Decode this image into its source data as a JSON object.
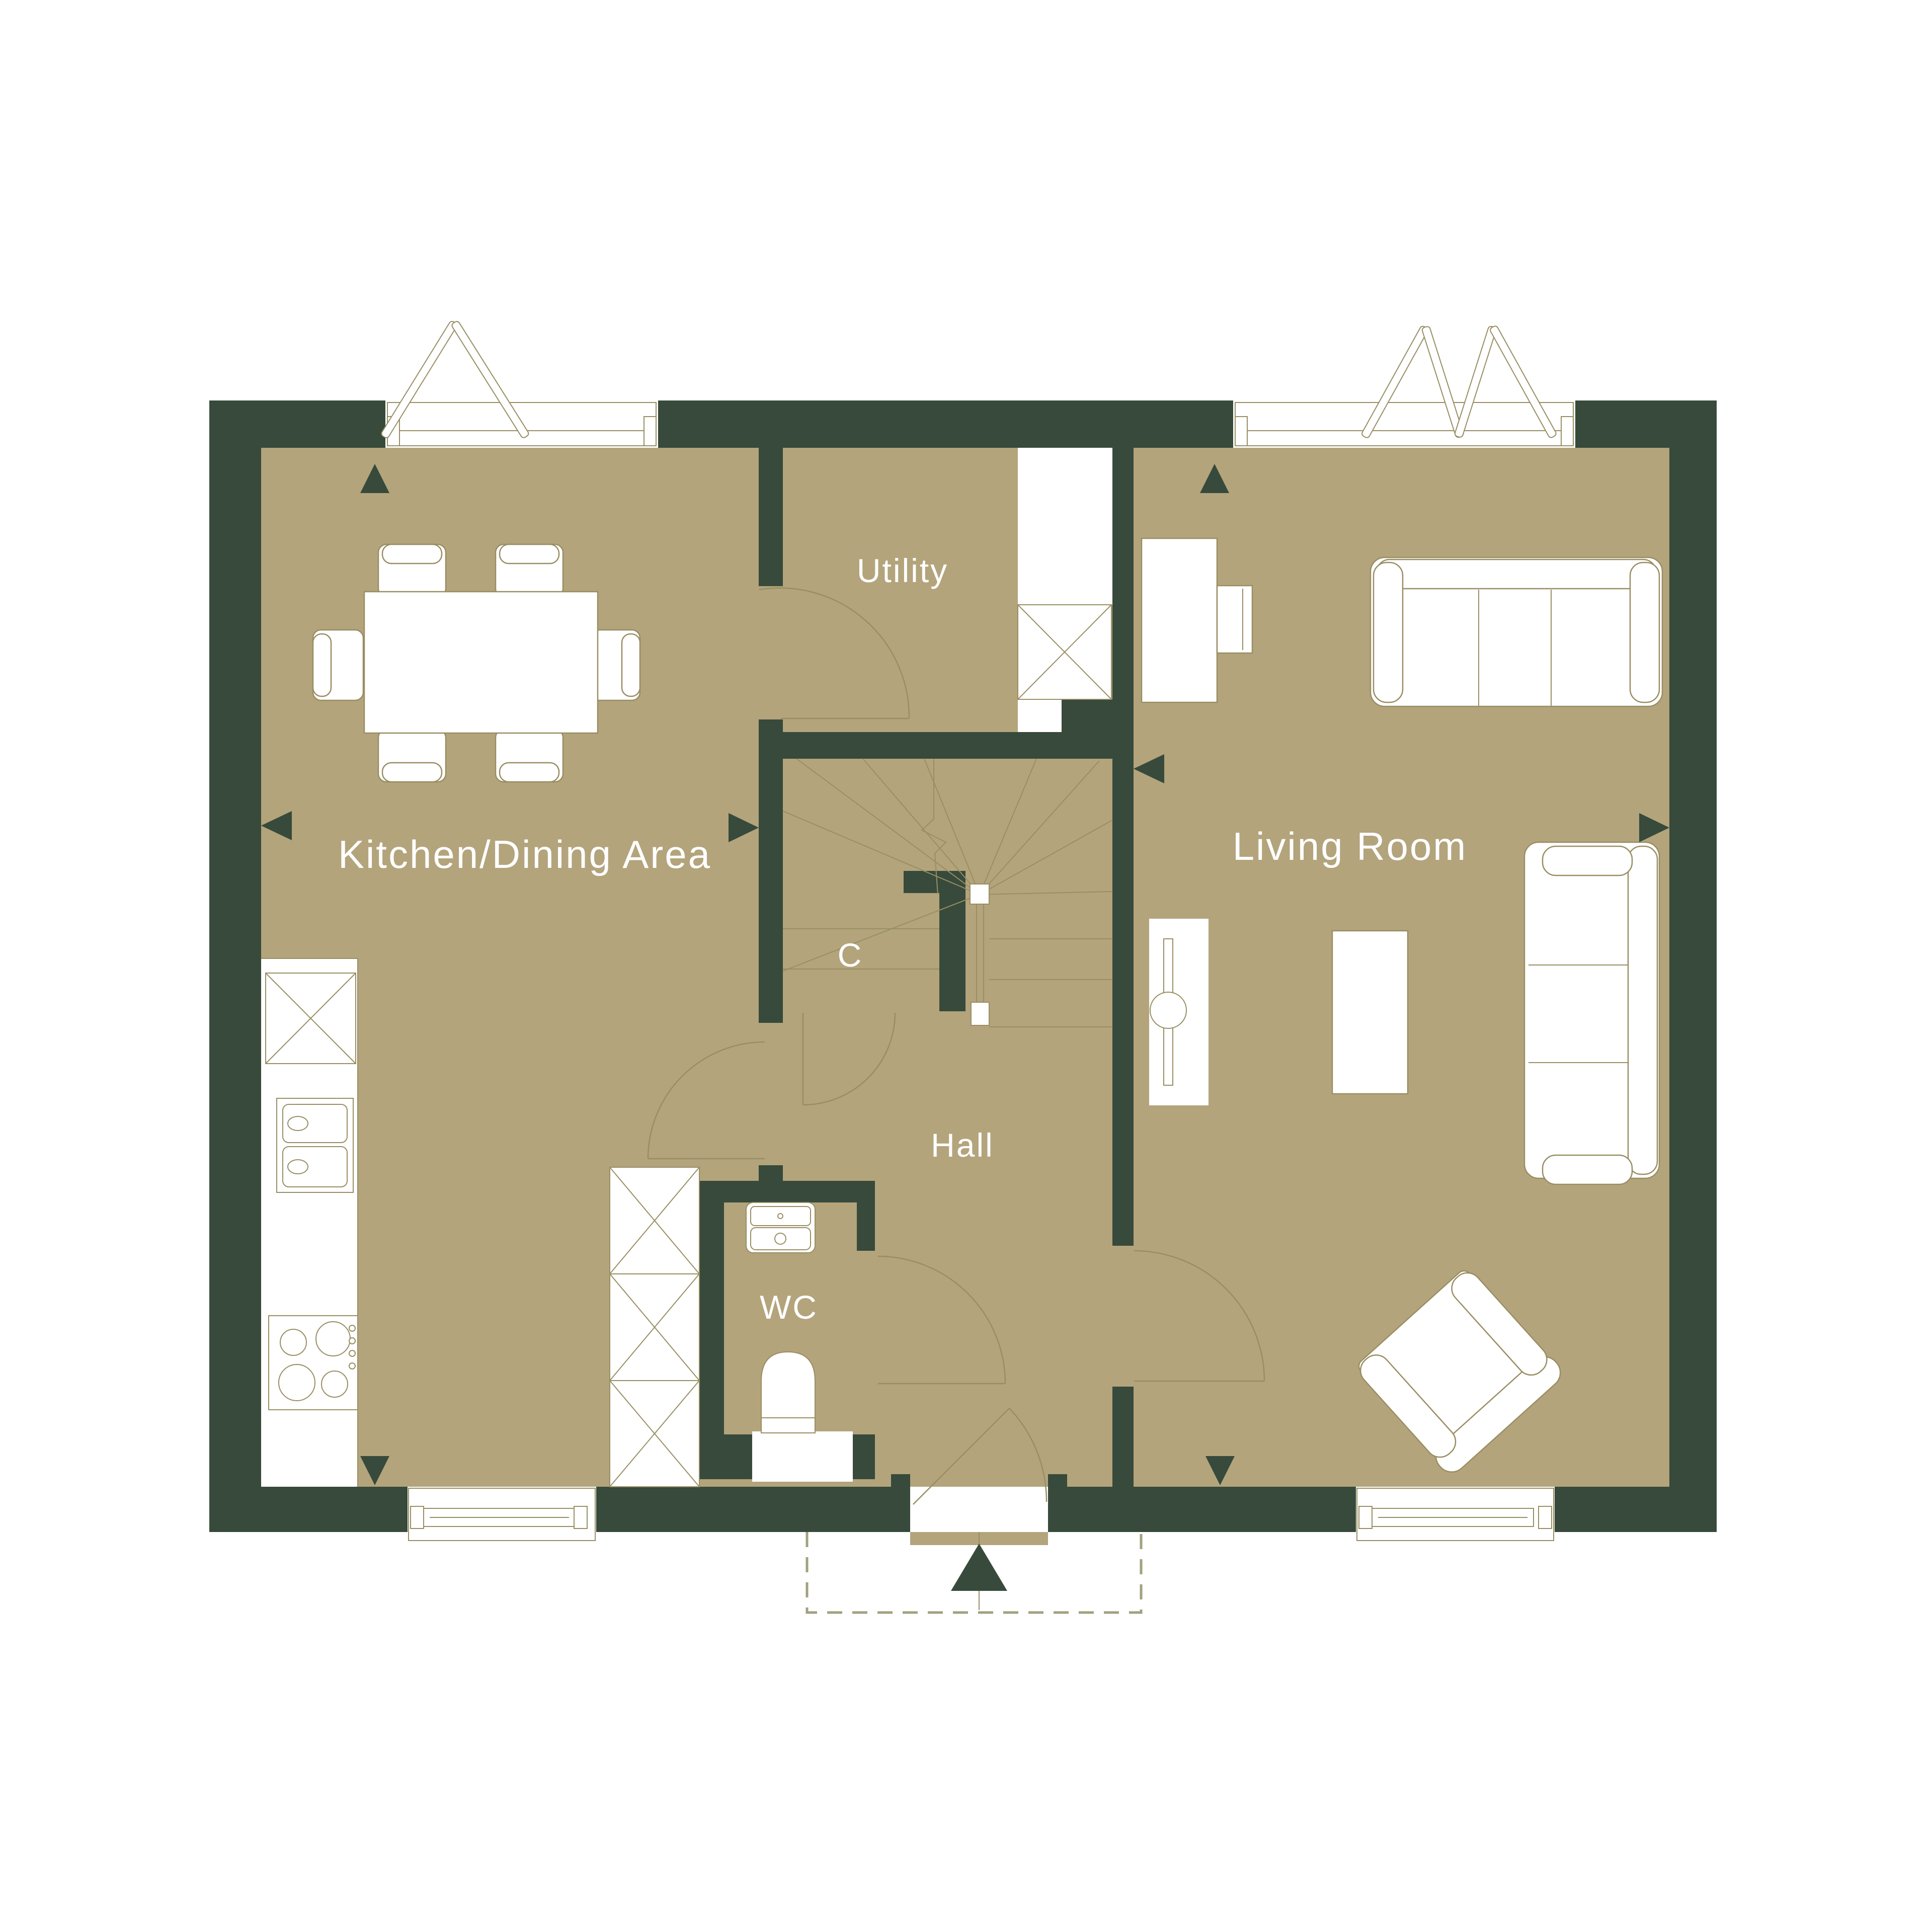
{
  "plan": {
    "title": "Ground floor plan",
    "rooms": {
      "kitchen": {
        "label": "Kitchen/Dining Area"
      },
      "utility": {
        "label": "Utility"
      },
      "living": {
        "label": "Living Room"
      },
      "hall": {
        "label": "Hall"
      },
      "wc": {
        "label": "WC"
      },
      "cupboard": {
        "label": "C"
      }
    },
    "colors": {
      "wall": "#374a3b",
      "floor": "#b3a47c",
      "line": "#998e63",
      "dash": "#a1a17f",
      "label": "#ffffff"
    },
    "furniture": [
      "dining-table",
      "dining-chair",
      "kitchen-counter",
      "fridge-freezer-unit",
      "double-sink",
      "hob",
      "tall-storage-cupboard",
      "utility-worktop",
      "washing-machine",
      "staircase",
      "handrail",
      "basin",
      "toilet",
      "sofa-three-seat",
      "sofa-two-seat",
      "armchair",
      "coffee-table",
      "desk",
      "desk-chair",
      "radiator"
    ],
    "symbols": [
      "window",
      "open-casement",
      "door-swing",
      "entrance-arrow",
      "porch-outline",
      "direction-arrow"
    ]
  }
}
